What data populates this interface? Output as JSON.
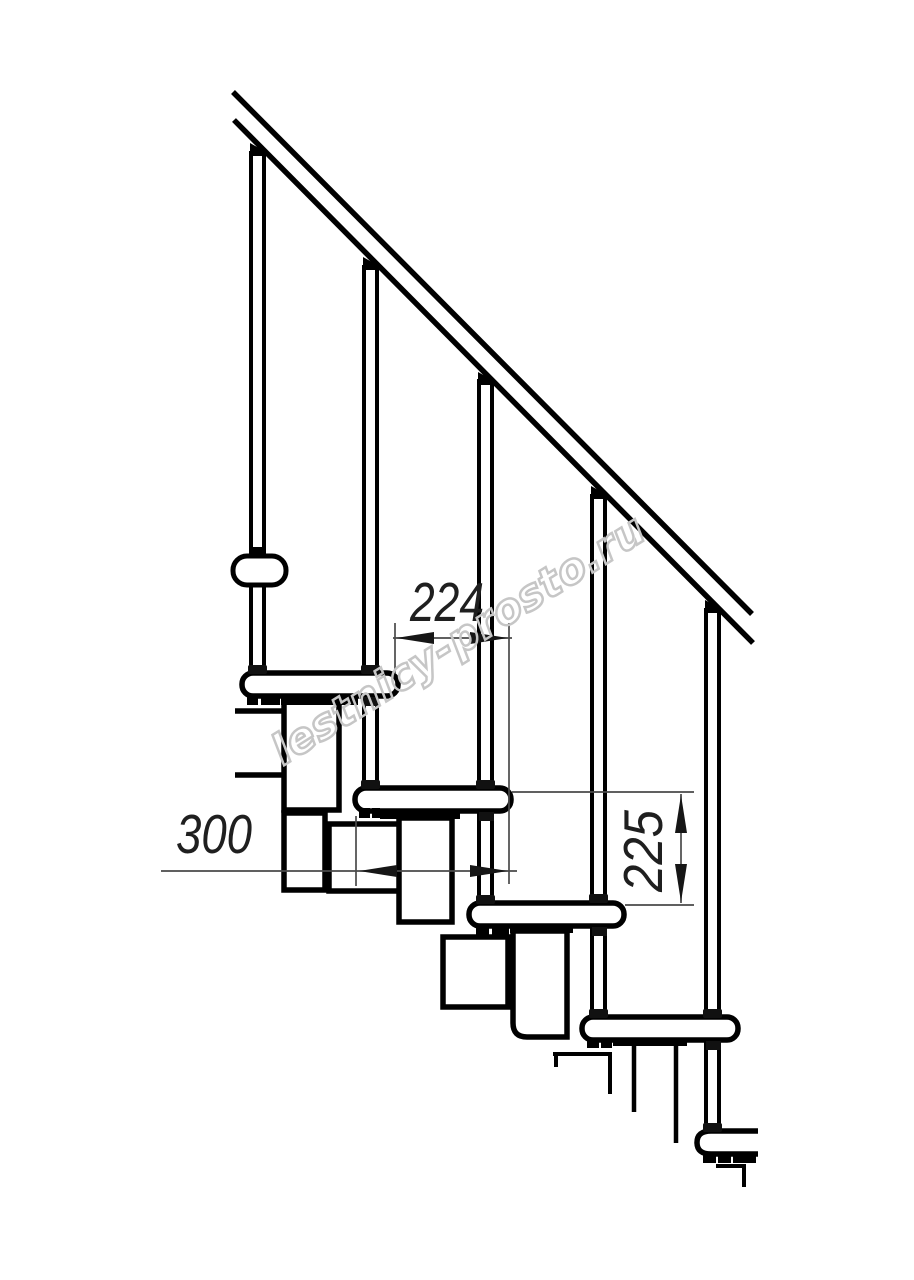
{
  "drawing": {
    "kind": "staircase-side-elevation"
  },
  "dimensions": {
    "run": {
      "label": "224"
    },
    "depth": {
      "label": "300"
    },
    "rise": {
      "label": "225"
    }
  },
  "watermark": {
    "text": "lestnicy-prosto.ru"
  },
  "colors": {
    "line": "#000000",
    "fill": "#ffffff",
    "dimension_line": "#4a4a4a",
    "dimension_text": "#1f1f1f",
    "watermark": "#c6c6c6",
    "background": "#ffffff"
  }
}
